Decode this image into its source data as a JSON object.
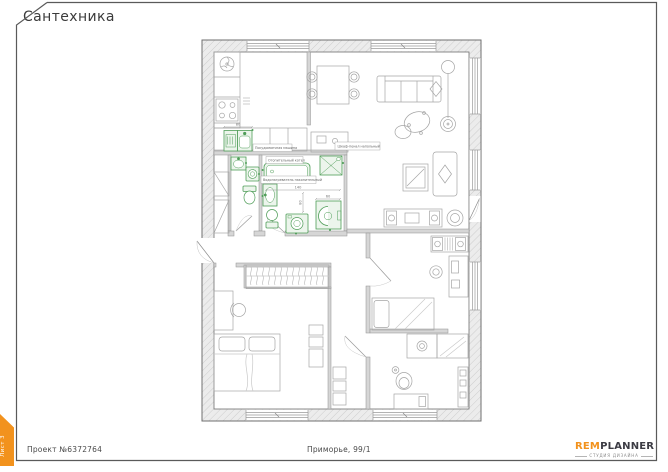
{
  "sheet": {
    "title": "Сантехника"
  },
  "side_tab": {
    "label": "Лист 3",
    "color": "#f2921d"
  },
  "footer": {
    "project": "Проект №6372764",
    "address": "Приморье, 99/1"
  },
  "logo": {
    "brand_orange": "REM",
    "brand_dark": "PLANNER",
    "tagline": "СТУДИЯ ДИЗАЙНА"
  },
  "plan": {
    "labels": {
      "dishwasher": "Посудомоечная машина",
      "floor_cabinet": "Шкаф-пенал напольный",
      "boiler": "Отопительный котел",
      "water_heater": "Водонагреватель накопительный"
    },
    "dimensions": {
      "kitchen_sink_width": "80",
      "bath_width": "140",
      "bath_depth": "80",
      "shower_width": "60"
    },
    "colors": {
      "sanitary": "#4f9d58",
      "sanitary_fill": "#ecf5ec",
      "wall_outline": "#6f6f6f",
      "wall_fill": "#ebebeb"
    }
  }
}
